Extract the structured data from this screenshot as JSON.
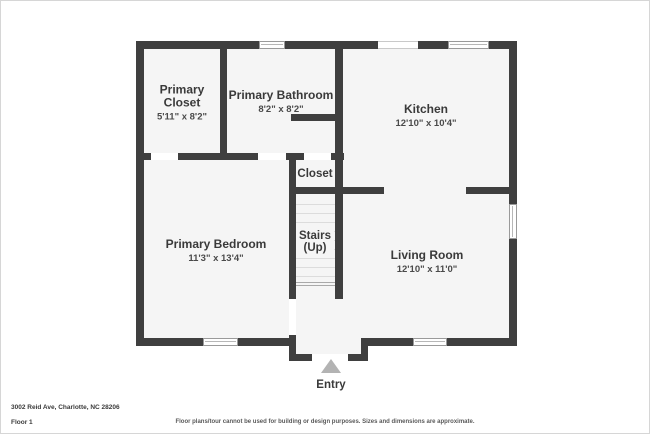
{
  "title": "Floor plan - Floor 1",
  "colors": {
    "wall": "#3f3f3f",
    "room_fill": "#f5f5f5",
    "window_frame": "#9a9a9a",
    "stair_tread": "#dcdcdc",
    "entry_arrow": "#b3b3b3",
    "text": "#3a3a3a"
  },
  "rooms": [
    {
      "name": "Primary Closet",
      "dims": "5'11\" x 8'2\""
    },
    {
      "name": "Primary Bathroom",
      "dims": "8'2\" x 8'2\""
    },
    {
      "name": "Kitchen",
      "dims": "12'10\" x 10'4\""
    },
    {
      "name": "Primary Bedroom",
      "dims": "11'3\" x 13'4\""
    },
    {
      "name": "Living Room",
      "dims": "12'10\" x 11'0\""
    },
    {
      "name": "Closet"
    },
    {
      "name": "Stairs",
      "sub": "(Up)"
    },
    {
      "name": "Entry"
    }
  ],
  "footer": {
    "address": "3002 Reid Ave, Charlotte, NC 28206",
    "floor": "Floor 1",
    "disclaimer": "Floor plans/tour cannot be used for building or design purposes. Sizes and dimensions are approximate."
  }
}
